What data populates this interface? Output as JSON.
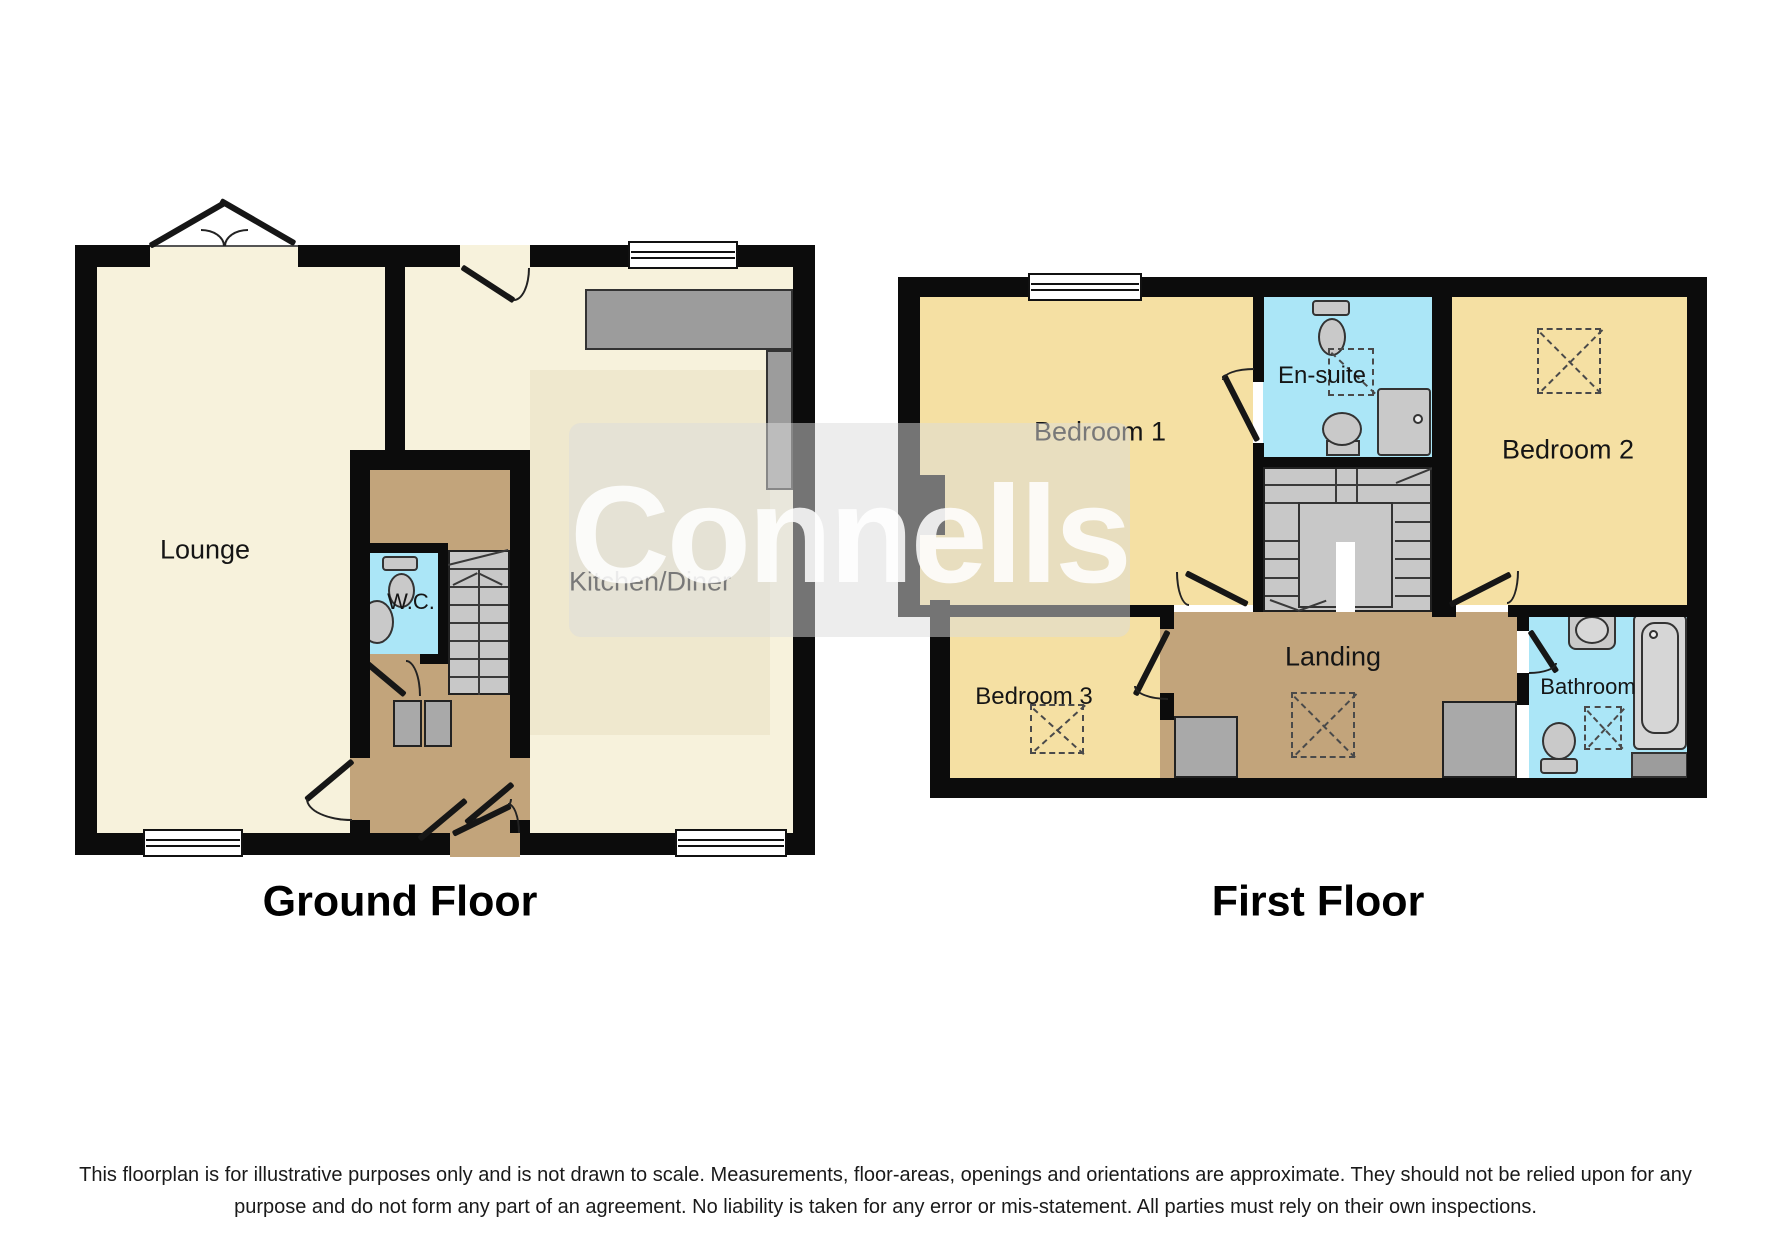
{
  "watermark": {
    "text": "Connells"
  },
  "titles": {
    "ground": "Ground Floor",
    "first": "First Floor"
  },
  "rooms": {
    "lounge": "Lounge",
    "wc": "W.C.",
    "kitchen": "Kitchen/Diner",
    "bedroom1": "Bedroom 1",
    "ensuite": "En-suite",
    "bedroom2": "Bedroom 2",
    "bedroom3": "Bedroom 3",
    "landing": "Landing",
    "bathroom": "Bathroom"
  },
  "disclaimer": {
    "line1": "This floorplan is for illustrative purposes only and is not drawn to scale. Measurements, floor-areas, openings and orientations are approximate. They should not be relied upon for any",
    "line2": "purpose and do not form any part of an agreement. No liability is taken for any error or mis-statement. All parties must rely on their own inspections."
  },
  "colors": {
    "wall": "#0c0c0c",
    "floor_cream": "#F7F2DC",
    "floor_cream_inner": "#EFE8CE",
    "floor_yellow": "#F5E0A3",
    "floor_brown": "#C2A47B",
    "wet_blue": "#ABE6F7",
    "stair_gray": "#C8C8C8",
    "counter_gray": "#9C9C9C",
    "fixture_gray": "#C9C9C9"
  }
}
